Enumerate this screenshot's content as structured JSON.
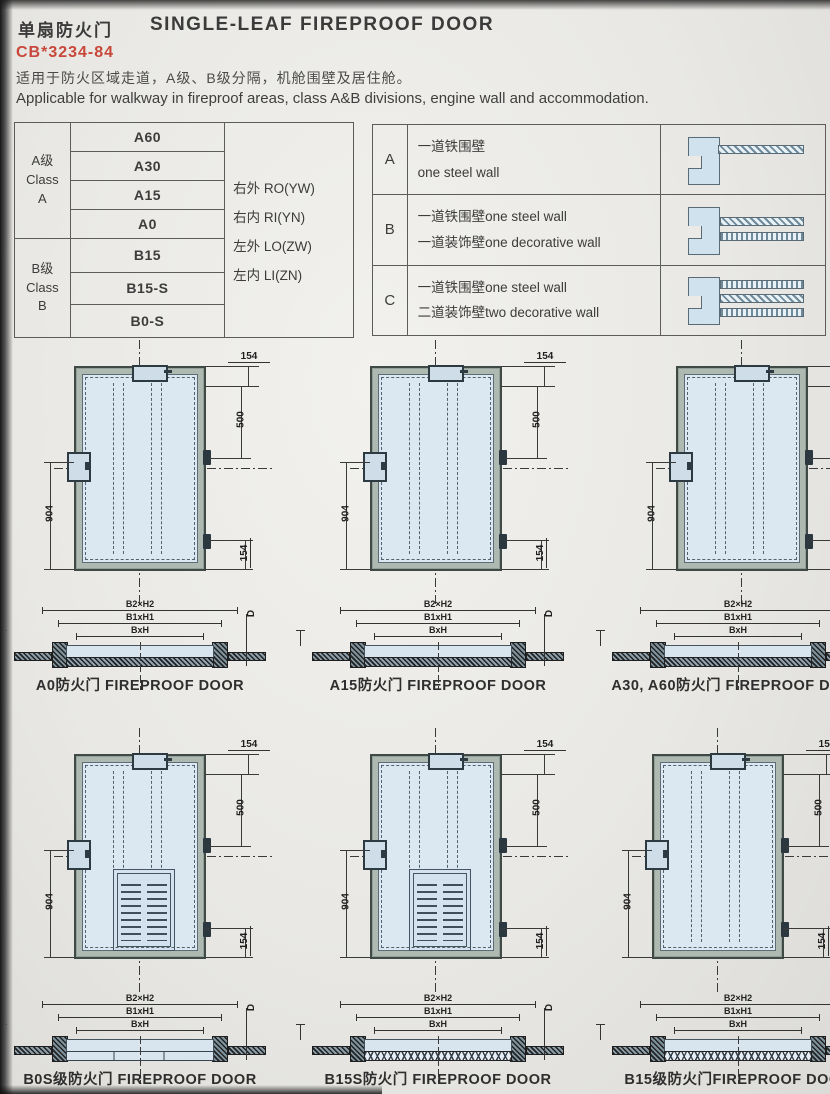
{
  "header": {
    "title_cn": "单扇防火门",
    "title_en": "SINGLE-LEAF FIREPROOF DOOR",
    "standard_no": "CB*3234-84",
    "desc_cn": "适用于防火区域走道，A级、B级分隔，机舱围壁及居住舱。",
    "desc_en": "Applicable for walkway in fireproof areas, class A&B divisions, engine wall and accommodation."
  },
  "class_table": {
    "group_a": {
      "lines": [
        "A级",
        "Class",
        "A"
      ],
      "types": [
        "A60",
        "A30",
        "A15",
        "A0"
      ]
    },
    "group_b": {
      "lines": [
        "B级",
        "Class",
        "B"
      ],
      "types": [
        "B15",
        "B15-S",
        "B0-S"
      ]
    },
    "orientations": [
      "右外 RO(YW)",
      "右内 RI(YN)",
      "左外 LO(ZW)",
      "左内 LI(ZN)"
    ]
  },
  "wall_table": {
    "rows": [
      {
        "key": "A",
        "line1": "一道铁围壁",
        "line2": "one steel wall"
      },
      {
        "key": "B",
        "line1": "一道铁围壁one steel wall",
        "line2": "一道装饰壁one decorative wall"
      },
      {
        "key": "C",
        "line1": "一道铁围壁one steel wall",
        "line2": "二道装饰壁two decorative wall"
      }
    ]
  },
  "dims": {
    "top": "154",
    "right": "500",
    "left": "904",
    "bottom": "154"
  },
  "section_labels": {
    "outer": "B2×H2",
    "mid": "B1xH1",
    "inner": "BxH",
    "depth": "D"
  },
  "captions": {
    "row1": [
      "A0防火门 FIREPROOF DOOR",
      "A15防火门 FIREPROOF DOOR",
      "A30, A60防火门 FIREPROOF DOOR"
    ],
    "row2": [
      "B0S级防火门 FIREPROOF DOOR",
      "B15S防火门 FIREPROOF DOOR",
      "B15级防火门FIREPROOF DOOR"
    ]
  },
  "colors": {
    "accent_red": "#c8473a",
    "leaf_blue": "#dce8f1",
    "frame_gray": "#aeb9b2"
  }
}
